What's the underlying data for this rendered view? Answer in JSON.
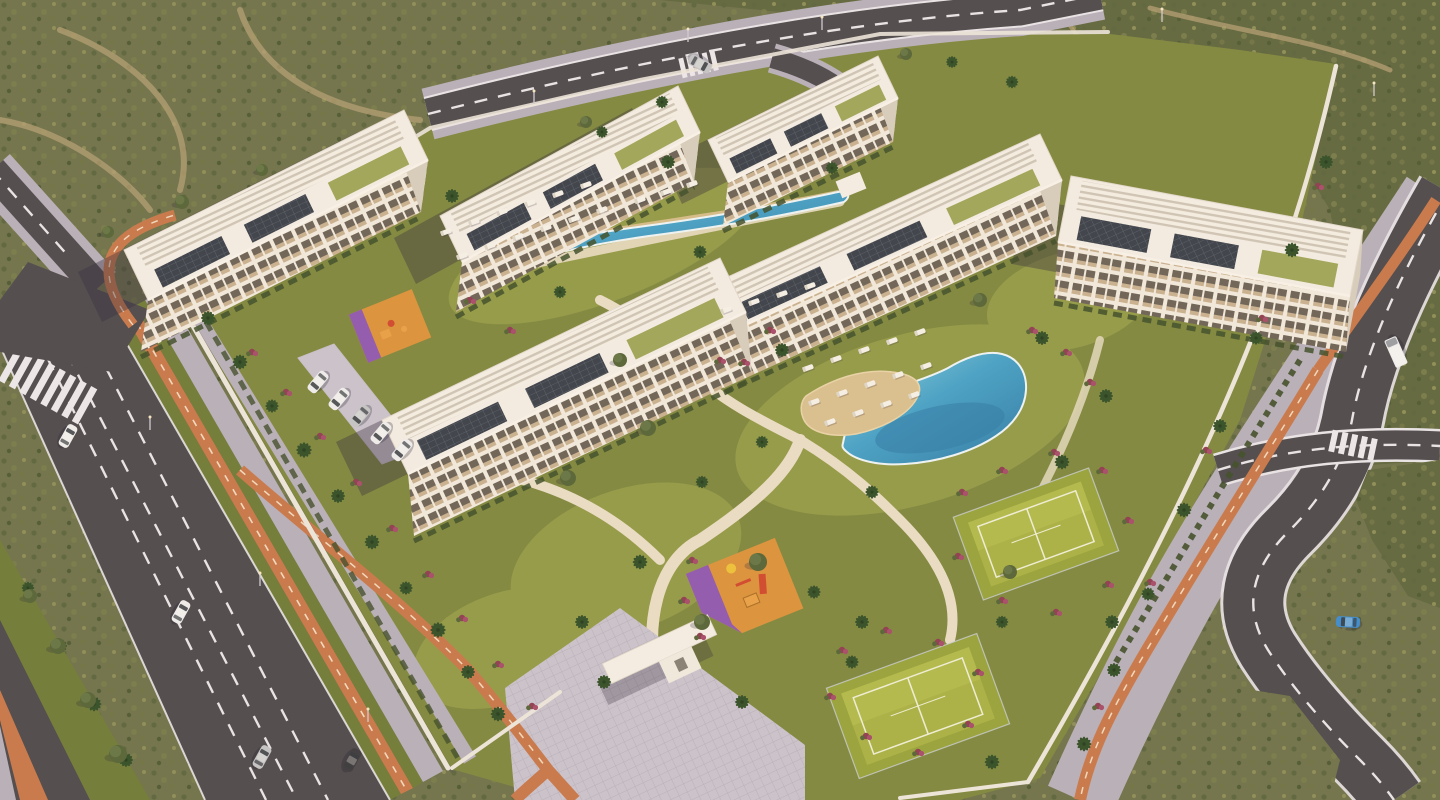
{
  "meta": {
    "type": "architectural-aerial-render",
    "description": "Golden-hour aerial 3D render of a white low-rise residential resort complex: six apartment blocks with pergola rooftops and solar panels, two swimming pools with sun loungers, two padel tennis courts, two playgrounds, palm-lined avenues with orange bike lanes, surrounded by desert scrubland",
    "time_of_day": "sunset"
  },
  "palette": {
    "desert1": "#6e7450",
    "desert2": "#5f6943",
    "desertPath": "#b3a077",
    "asphalt": "#4c4b51",
    "asphaltD": "#434247",
    "lane": "#e8e8ec",
    "bike": "#c87a4f",
    "bikeDash": "#f0ddc5",
    "walk": "#b7b2bf",
    "walkLight": "#cac6d2",
    "grass": "#7e8a43",
    "grassLight": "#96a04f",
    "verge": "#6f7d3c",
    "hedge": "#3d4f2d",
    "path": "#dacfb2",
    "pathLight": "#e9e0ca",
    "wall": "#ece8e1",
    "shadow": "rgba(48,42,66,.38)",
    "bldRoof": "#f4f0e9",
    "bldWall": "#f1ece2",
    "bldSide": "#d6cfc2",
    "bldEdge": "#e2dcd2",
    "win": "#6b655b",
    "balc": "#c8b394",
    "poolEdge": "#eef7fa",
    "poolDeep": "#2d7cab",
    "deck": "#d9c194",
    "deckLight": "#e8d6ac",
    "court": "#a9b449",
    "courtLight": "#bcc457",
    "courtMargin": "#96a53f",
    "courtLine": "#eef2dc",
    "pgOrange": "#db9440",
    "pgPurple": "#8f5ab5",
    "palm": "#32512c",
    "palmDark": "#243e20",
    "trunk": "#8e7e5f",
    "lounger": "#f5f3ed"
  },
  "scene": {
    "counts": {
      "apartment_blocks": 6,
      "pools": 2,
      "padel_courts": 2,
      "playgrounds": 2,
      "vehicles": 12
    },
    "buildings": [
      {
        "id": "block-3",
        "front": [
          728,
          182,
          898,
          98
        ],
        "depth": [
          -20,
          -42
        ],
        "h": 44,
        "lean": -5,
        "style": "sw"
      },
      {
        "id": "block-2",
        "front": [
          462,
          262,
          700,
          132
        ],
        "depth": [
          -22,
          -46
        ],
        "h": 50,
        "lean": -6,
        "style": "sw"
      },
      {
        "id": "block-1",
        "front": [
          148,
          300,
          428,
          160
        ],
        "depth": [
          -24,
          -50
        ],
        "h": 52,
        "lean": -7,
        "style": "sw"
      },
      {
        "id": "block-4",
        "front": [
          730,
          332,
          1062,
          180
        ],
        "depth": [
          -22,
          -46
        ],
        "h": 56,
        "lean": -6,
        "style": "sw"
      },
      {
        "id": "block-5",
        "front": [
          1058,
          242,
          1350,
          296
        ],
        "depth": [
          13,
          -66
        ],
        "h": 56,
        "lean": -4,
        "style": "e"
      },
      {
        "id": "block-6",
        "front": [
          408,
          474,
          746,
          312
        ],
        "depth": [
          -26,
          -54
        ],
        "h": 62,
        "lean": 6,
        "style": "sw"
      }
    ],
    "palms": [
      [
        208,
        318,
        1
      ],
      [
        240,
        362,
        1.05
      ],
      [
        272,
        406,
        0.95
      ],
      [
        304,
        450,
        1.1
      ],
      [
        338,
        496,
        1
      ],
      [
        372,
        542,
        1.05
      ],
      [
        406,
        588,
        0.95
      ],
      [
        438,
        630,
        1.1
      ],
      [
        468,
        672,
        1
      ],
      [
        498,
        714,
        1.05
      ],
      [
        28,
        588,
        0.9
      ],
      [
        60,
        646,
        1
      ],
      [
        94,
        704,
        1.05
      ],
      [
        126,
        760,
        1
      ],
      [
        452,
        196,
        1
      ],
      [
        560,
        292,
        0.9
      ],
      [
        668,
        162,
        1
      ],
      [
        700,
        252,
        0.95
      ],
      [
        832,
        168,
        0.9
      ],
      [
        782,
        350,
        1
      ],
      [
        1042,
        338,
        1
      ],
      [
        1062,
        462,
        1.05
      ],
      [
        872,
        492,
        0.95
      ],
      [
        762,
        442,
        0.9
      ],
      [
        1106,
        396,
        1
      ],
      [
        640,
        562,
        1.05
      ],
      [
        702,
        482,
        0.9
      ],
      [
        582,
        622,
        1
      ],
      [
        814,
        592,
        0.95
      ],
      [
        862,
        622,
        1
      ],
      [
        1002,
        622,
        0.9
      ],
      [
        1112,
        622,
        1
      ],
      [
        852,
        662,
        0.95
      ],
      [
        992,
        762,
        1.05
      ],
      [
        1326,
        162,
        1
      ],
      [
        1292,
        250,
        1.05
      ],
      [
        1256,
        338,
        0.95
      ],
      [
        1220,
        426,
        1
      ],
      [
        1184,
        510,
        1.05
      ],
      [
        1148,
        594,
        0.95
      ],
      [
        1114,
        670,
        1
      ],
      [
        1084,
        744,
        1.05
      ],
      [
        602,
        132,
        0.85
      ],
      [
        662,
        102,
        0.9
      ],
      [
        952,
        62,
        0.85
      ],
      [
        1012,
        82,
        0.9
      ],
      [
        604,
        682,
        1
      ],
      [
        742,
        702,
        1
      ]
    ],
    "round_trees": [
      [
        30,
        596,
        7
      ],
      [
        58,
        646,
        8
      ],
      [
        88,
        700,
        8
      ],
      [
        118,
        754,
        9
      ],
      [
        108,
        232,
        6
      ],
      [
        182,
        202,
        7
      ],
      [
        262,
        170,
        6
      ],
      [
        648,
        428,
        8
      ],
      [
        568,
        478,
        8
      ],
      [
        758,
        562,
        9
      ],
      [
        702,
        622,
        8
      ],
      [
        1010,
        572,
        7
      ],
      [
        586,
        122,
        6
      ],
      [
        906,
        54,
        6
      ],
      [
        980,
        300,
        7
      ],
      [
        620,
        360,
        7
      ]
    ],
    "shrubs": [
      [
        252,
        352
      ],
      [
        286,
        392
      ],
      [
        320,
        436
      ],
      [
        356,
        482
      ],
      [
        392,
        528
      ],
      [
        428,
        574
      ],
      [
        462,
        618
      ],
      [
        498,
        664
      ],
      [
        532,
        706
      ],
      [
        962,
        492
      ],
      [
        1002,
        470
      ],
      [
        1054,
        452
      ],
      [
        1102,
        470
      ],
      [
        1128,
        520
      ],
      [
        1108,
        584
      ],
      [
        1056,
        612
      ],
      [
        1002,
        600
      ],
      [
        958,
        556
      ],
      [
        842,
        650
      ],
      [
        886,
        630
      ],
      [
        938,
        642
      ],
      [
        978,
        672
      ],
      [
        968,
        724
      ],
      [
        918,
        752
      ],
      [
        866,
        736
      ],
      [
        830,
        696
      ],
      [
        1032,
        330
      ],
      [
        1066,
        352
      ],
      [
        1090,
        382
      ],
      [
        770,
        330
      ],
      [
        744,
        362
      ],
      [
        692,
        560
      ],
      [
        684,
        600
      ],
      [
        700,
        636
      ],
      [
        1318,
        186
      ],
      [
        1262,
        318
      ],
      [
        1206,
        450
      ],
      [
        1150,
        582
      ],
      [
        1098,
        706
      ],
      [
        470,
        300
      ],
      [
        510,
        330
      ],
      [
        720,
        360
      ]
    ],
    "loungers": [
      [
        446,
        232
      ],
      [
        474,
        222
      ],
      [
        502,
        212
      ],
      [
        530,
        203
      ],
      [
        558,
        194
      ],
      [
        586,
        185
      ],
      [
        462,
        256
      ],
      [
        490,
        246
      ],
      [
        518,
        237
      ],
      [
        546,
        228
      ],
      [
        574,
        219
      ],
      [
        602,
        210
      ],
      [
        640,
        200
      ],
      [
        666,
        192
      ],
      [
        692,
        184
      ],
      [
        726,
        310
      ],
      [
        754,
        302
      ],
      [
        782,
        294
      ],
      [
        810,
        286
      ],
      [
        808,
        368
      ],
      [
        836,
        359
      ],
      [
        864,
        350
      ],
      [
        892,
        341
      ],
      [
        920,
        332
      ],
      [
        814,
        402
      ],
      [
        842,
        393
      ],
      [
        870,
        384
      ],
      [
        898,
        375
      ],
      [
        926,
        366
      ],
      [
        830,
        422
      ],
      [
        858,
        413
      ],
      [
        886,
        404
      ],
      [
        914,
        395
      ]
    ],
    "cars": [
      [
        68,
        436,
        29,
        "#eef0f2",
        0
      ],
      [
        181,
        612,
        29,
        "#eef0f2",
        0
      ],
      [
        262,
        757,
        29,
        "#c3c6cb",
        0
      ],
      [
        352,
        760,
        29,
        "#3c3d43",
        0
      ],
      [
        1396,
        352,
        156,
        "#eef0f2",
        1
      ],
      [
        1348,
        622,
        -87,
        "#3b8ed2",
        0
      ],
      [
        318,
        382,
        -140,
        "#eef0f2",
        0
      ],
      [
        339,
        399,
        -140,
        "#eef0f2",
        0
      ],
      [
        360,
        416,
        -140,
        "#c3c6cb",
        0
      ],
      [
        381,
        433,
        -140,
        "#eef0f2",
        0
      ],
      [
        402,
        450,
        -140,
        "#eef0f2",
        0
      ],
      [
        700,
        64,
        119,
        "#c3c6cb",
        0
      ]
    ],
    "streetlights": [
      [
        688,
        42
      ],
      [
        822,
        30
      ],
      [
        534,
        104
      ],
      [
        1162,
        22
      ],
      [
        1374,
        96
      ],
      [
        150,
        430
      ],
      [
        260,
        586
      ],
      [
        368,
        722
      ]
    ]
  }
}
